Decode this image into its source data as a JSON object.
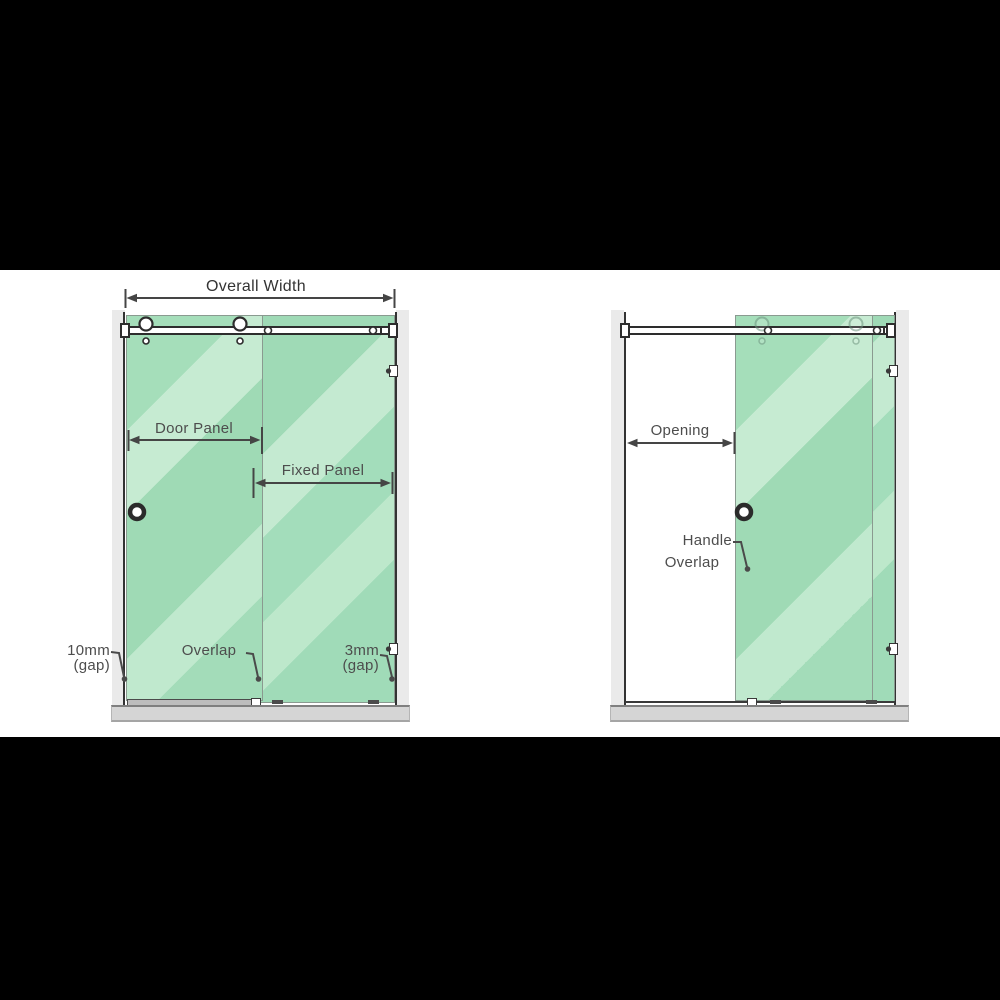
{
  "figure": {
    "description": "Sliding shower screen dimension diagram, closed and open positions",
    "colors": {
      "letterbox": "#000000",
      "panel_background": "#ffffff",
      "glass_base": "#a3ddbb",
      "glass_highlight": "#c6ebd2",
      "glass_outline": "#8a9a90",
      "frame_dark": "#2d2d2d",
      "dimension_line": "#454545",
      "label_text": "#4d4d4d",
      "title_text": "#333333",
      "wall_strip": "#eaeaea",
      "tray": "#d5d5d5"
    }
  },
  "left_diagram": {
    "name": "closed position",
    "labels": {
      "overall_width": "Overall Width",
      "door_panel": "Door Panel",
      "fixed_panel": "Fixed Panel",
      "gap_left_value": "10mm",
      "gap_left_unit": "(gap)",
      "overlap": "Overlap",
      "gap_right_value": "3mm",
      "gap_right_unit": "(gap)"
    }
  },
  "right_diagram": {
    "name": "open position",
    "labels": {
      "opening": "Opening",
      "handle": "Handle",
      "overlap": "Overlap"
    }
  }
}
